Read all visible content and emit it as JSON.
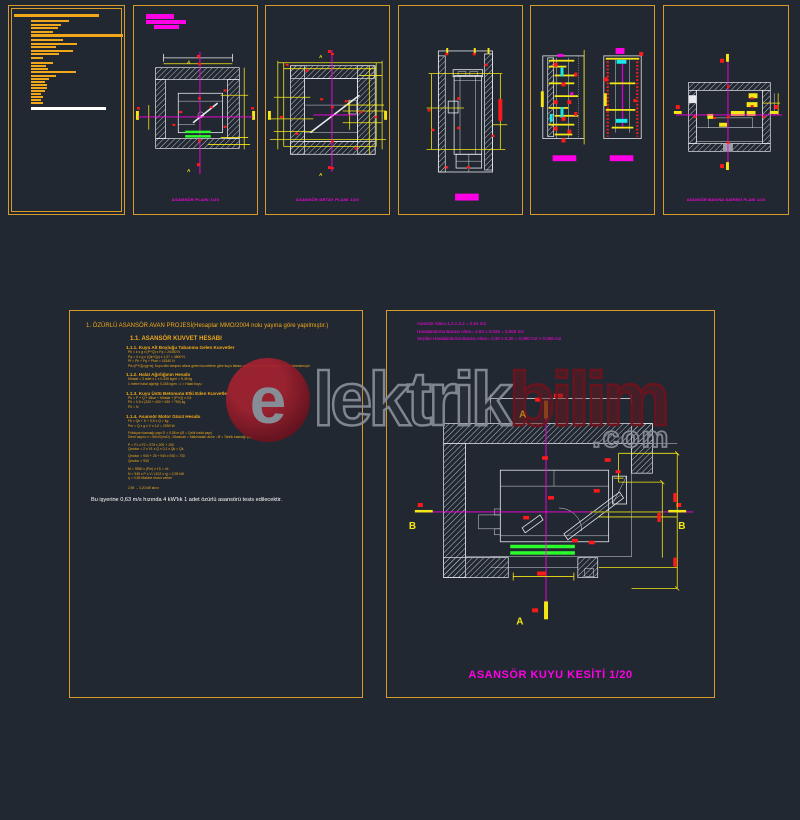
{
  "colors": {
    "background": "#222831",
    "frame_orange": "#d99b28",
    "note_amber": "#f0a81a",
    "dim_yellow": "#f5e616",
    "magenta": "#ff00e6",
    "green": "#2bff2b",
    "red": "#ff1a1a",
    "cyan": "#19e8e8",
    "white": "#e8eaee",
    "watermark_red": "#a32230",
    "watermark_gray": "#878e98"
  },
  "watermark": {
    "e": "e",
    "mid": "lektrik",
    "end": "bilim",
    "domain": ".com"
  },
  "notes": {
    "lines": [
      [
        5,
        8,
        85,
        3,
        "a"
      ],
      [
        22,
        14,
        38,
        2.2,
        "a"
      ],
      [
        22,
        17.5,
        30,
        2.2,
        "a"
      ],
      [
        22,
        21,
        27,
        2.2,
        "a"
      ],
      [
        22,
        24.5,
        22,
        2.2,
        "a"
      ],
      [
        22,
        28,
        92,
        2.6,
        "a"
      ],
      [
        22,
        33,
        32,
        2.2,
        "a"
      ],
      [
        22,
        36.5,
        46,
        2.2,
        "a"
      ],
      [
        22,
        40,
        25,
        2.2,
        "a"
      ],
      [
        22,
        43.5,
        42,
        2.2,
        "a"
      ],
      [
        22,
        47,
        28,
        2.2,
        "a"
      ],
      [
        22,
        50.5,
        12,
        2.2,
        "a"
      ],
      [
        22,
        55.5,
        22,
        2.2,
        "a"
      ],
      [
        22,
        58.5,
        15,
        2.2,
        "a"
      ],
      [
        22,
        61.5,
        17,
        2.2,
        "a"
      ],
      [
        22,
        65,
        45,
        2.2,
        "a"
      ],
      [
        22,
        68.5,
        25,
        2.2,
        "a"
      ],
      [
        22,
        72,
        18,
        2.2,
        "a"
      ],
      [
        22,
        75,
        14,
        2.2,
        "a"
      ],
      [
        22,
        78,
        16,
        2.2,
        "a"
      ],
      [
        22,
        81,
        16,
        2.2,
        "a"
      ],
      [
        22,
        84,
        14,
        2.2,
        "a"
      ],
      [
        22,
        87,
        10,
        2.2,
        "a"
      ],
      [
        22,
        90,
        12,
        2.2,
        "a"
      ],
      [
        22,
        93,
        10,
        2.2,
        "a"
      ],
      [
        22,
        96,
        12,
        2.2,
        "a"
      ],
      [
        22,
        101,
        75,
        3,
        "w"
      ]
    ]
  },
  "sheets": {
    "plan1": {
      "title": "ASANSÖR PLANI  1/20"
    },
    "plan2": {
      "title": "ASANSÖR DETAY PLANI  1/20"
    },
    "machine_plan": {
      "title": "ASANSÖR MAKİNA DAİRESİ PLANI  1/20"
    }
  },
  "calc": {
    "rows": [
      {
        "c": "h1",
        "t": "1. ÖZÜRLÜ ASANSÖR AVAN PROJESİ(Hesaplar MMO/2004 nolu yayına göre yapılmıştır.)"
      },
      {
        "c": "h2",
        "t": "1.1. ASANSÖR KUVVET HESABI",
        "mt": 7
      },
      {
        "c": "h3",
        "t": "1.1.1. Kuyu Alt Boşluğu Tabanına Gelen Kuvvetler"
      },
      {
        "c": "f",
        "t": "Pk = k x g x (P+Q) x Fq = 24450 N"
      },
      {
        "c": "f",
        "t": "Pq = 4 x g x (Qk+Qy) x 1,07 = 4800 N"
      },
      {
        "c": "f",
        "t": "Pt = Pk + Pq + Pkar = 41540 N"
      },
      {
        "c": "f",
        "t": "Pd=(P+Q)x(g+a); Kuyu dibi tampon altına gelen kuvvetlere göre kuyu tabanı güvenli kabul edildiğinden hesaplanmamıştır."
      },
      {
        "c": "h3",
        "t": "1.1.2. Halat Ağırlığının Hesabı",
        "mt": 4
      },
      {
        "c": "f",
        "t": "Mhalat = 3 adet x L x 0,345 kg/m = 9,45 kg"
      },
      {
        "c": "f",
        "t": "1 metre halat ağırlığı 0,345 kg/m ;  L = Halat boyu"
      },
      {
        "c": "h3",
        "t": "1.1.3. Kuyu Üstü Betonuna Etki Eden Kuvvetler",
        "mt": 4
      },
      {
        "c": "f",
        "t": "Pü = P + Q + Mkar + Mhalat + (P+Q) x 0,5"
      },
      {
        "c": "f",
        "t": "Pü = 0,5 x (320 + 400 + 630 + 750) kg"
      },
      {
        "c": "f",
        "t": "Pü = N"
      },
      {
        "c": "h3",
        "t": "1.1.4. Asansör Motor Gücü Hesabı",
        "mt": 5
      },
      {
        "c": "f",
        "t": "Fk = Qk + K + 0,5 x Q = kg"
      },
      {
        "c": "f",
        "t": "Pm = Q x g x V x 1,0 = 2950 W"
      },
      {
        "c": "f",
        "t": "Friksiyon kasnağı çapı D = 0,55 m (Ø = Çelik halat çapı)",
        "mt": 2
      },
      {
        "c": "f",
        "t": "Devir sayısı n = 60xV/(πxD) ; Dkasnak = Makinadan alınır ; Ø = Tahrik kasnağı çapı"
      },
      {
        "c": "f",
        "t": "P = F1 x F2 = 975 x 200 + 150",
        "mt": 3
      },
      {
        "c": "f",
        "t": "Qmotor = 2 x V1 x Q x 0,1 x Qk = Qk"
      },
      {
        "c": "f",
        "t": "Qmotor = 940 + 25 + 940 x 930 = 730",
        "mt": 2
      },
      {
        "c": "f",
        "t": "Qmotor = 930"
      },
      {
        "c": "f",
        "t": "M = 9550 x (P/n) x f.S = 44",
        "mt": 4
      },
      {
        "c": "f",
        "t": "N = 945 x P x V / (102 x η) = 2,95 kW"
      },
      {
        "c": "f",
        "t": "η = 0,55 Makine motor verimi"
      },
      {
        "c": "fsm",
        "t": "2,95 → 3,20 kW alınır",
        "mt": 5
      },
      {
        "c": "result",
        "t": "Bu işyerine 0,63 m/s hızında 4 kW'lık 1 adet özürlü asansörü tesis edilecektir."
      }
    ]
  },
  "shaft_section": {
    "info_lines": [
      "Asansör Alanı=1,2 x 2,2 = 2,64 m2",
      "Havalandırma Bacası Alanı= 2,64 x 0,025 = 0,066 m2",
      "Seçilen Havalandırma Bacası Alanı= 0,30 x 0,30 = 0,090 m2 > 0,066 m2"
    ],
    "title": "ASANSÖR KUYU KESİTİ   1/20",
    "labels": {
      "a_top": "A",
      "a_bottom": "A",
      "b_left": "B",
      "b_right": "B"
    }
  }
}
